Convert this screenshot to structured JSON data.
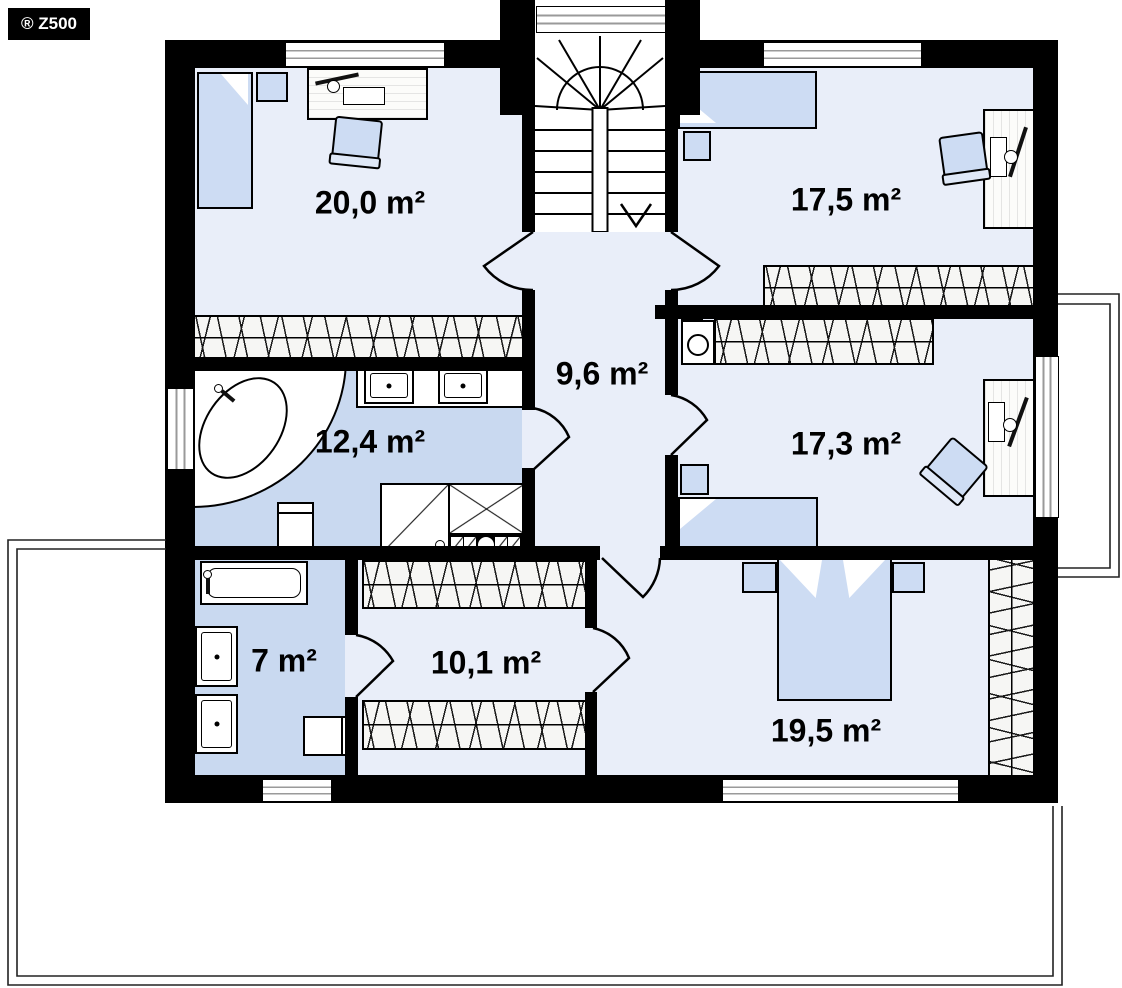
{
  "logo": {
    "text": "® Z500"
  },
  "plan_title": "First floor plan",
  "colors": {
    "wall": "#000000",
    "room_floor": "#e9eef9",
    "bath_floor": "#c9d9f0",
    "furniture_blue": "#cddcf3",
    "window_pane": "#9a9a9a",
    "outline": "#222222"
  },
  "rooms": [
    {
      "id": "bedroom-top-left",
      "area_label": "20,0 m²"
    },
    {
      "id": "bedroom-top-right",
      "area_label": "17,5 m²"
    },
    {
      "id": "hallway",
      "area_label": "9,6 m²"
    },
    {
      "id": "bathroom-main",
      "area_label": "12,4 m²"
    },
    {
      "id": "bedroom-mid-right",
      "area_label": "17,3 m²"
    },
    {
      "id": "bathroom-ensuite",
      "area_label": "7 m²"
    },
    {
      "id": "wardrobe-room",
      "area_label": "10,1 m²"
    },
    {
      "id": "bedroom-master",
      "area_label": "19,5 m²"
    }
  ]
}
